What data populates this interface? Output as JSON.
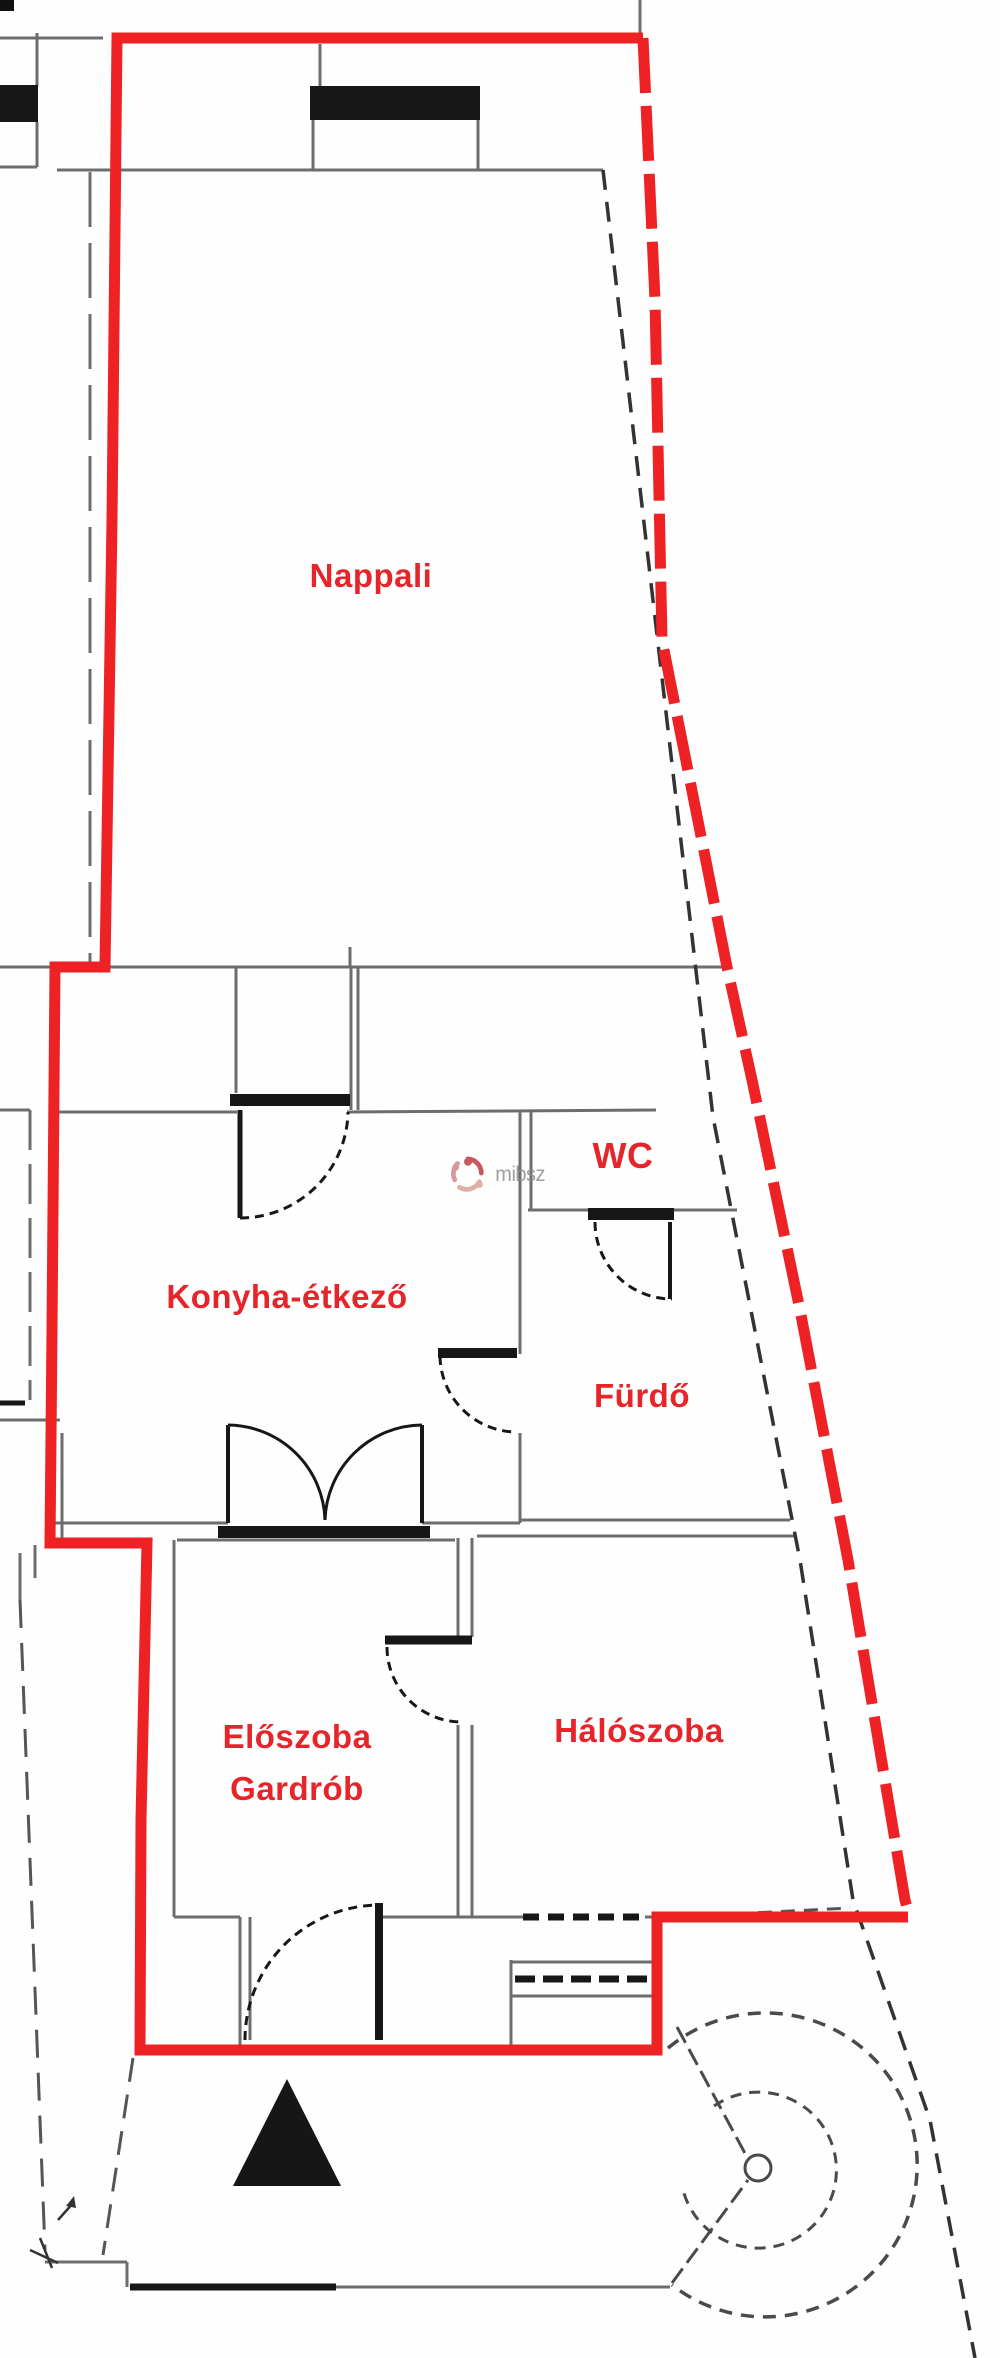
{
  "plan": {
    "type": "apartment-floor-plan",
    "rooms": [
      {
        "id": "nappali",
        "label": "Nappali"
      },
      {
        "id": "konyha-etkezo",
        "label": "Konyha-étkező"
      },
      {
        "id": "wc",
        "label": "WC"
      },
      {
        "id": "furdo",
        "label": "Fürdő"
      },
      {
        "id": "eloszoba-gardrob",
        "label": "Előszoba",
        "label_line2": "Gardrób"
      },
      {
        "id": "haloszoba",
        "label": "Hálószoba"
      }
    ],
    "watermark": {
      "text": "mibsz"
    },
    "colors": {
      "boundary_red": "#ee2224",
      "label_red": "#e6252b",
      "wall_gray": "#6d6d6d",
      "wall_black": "#171717",
      "watermark_gray": "#8f8f8f"
    }
  }
}
